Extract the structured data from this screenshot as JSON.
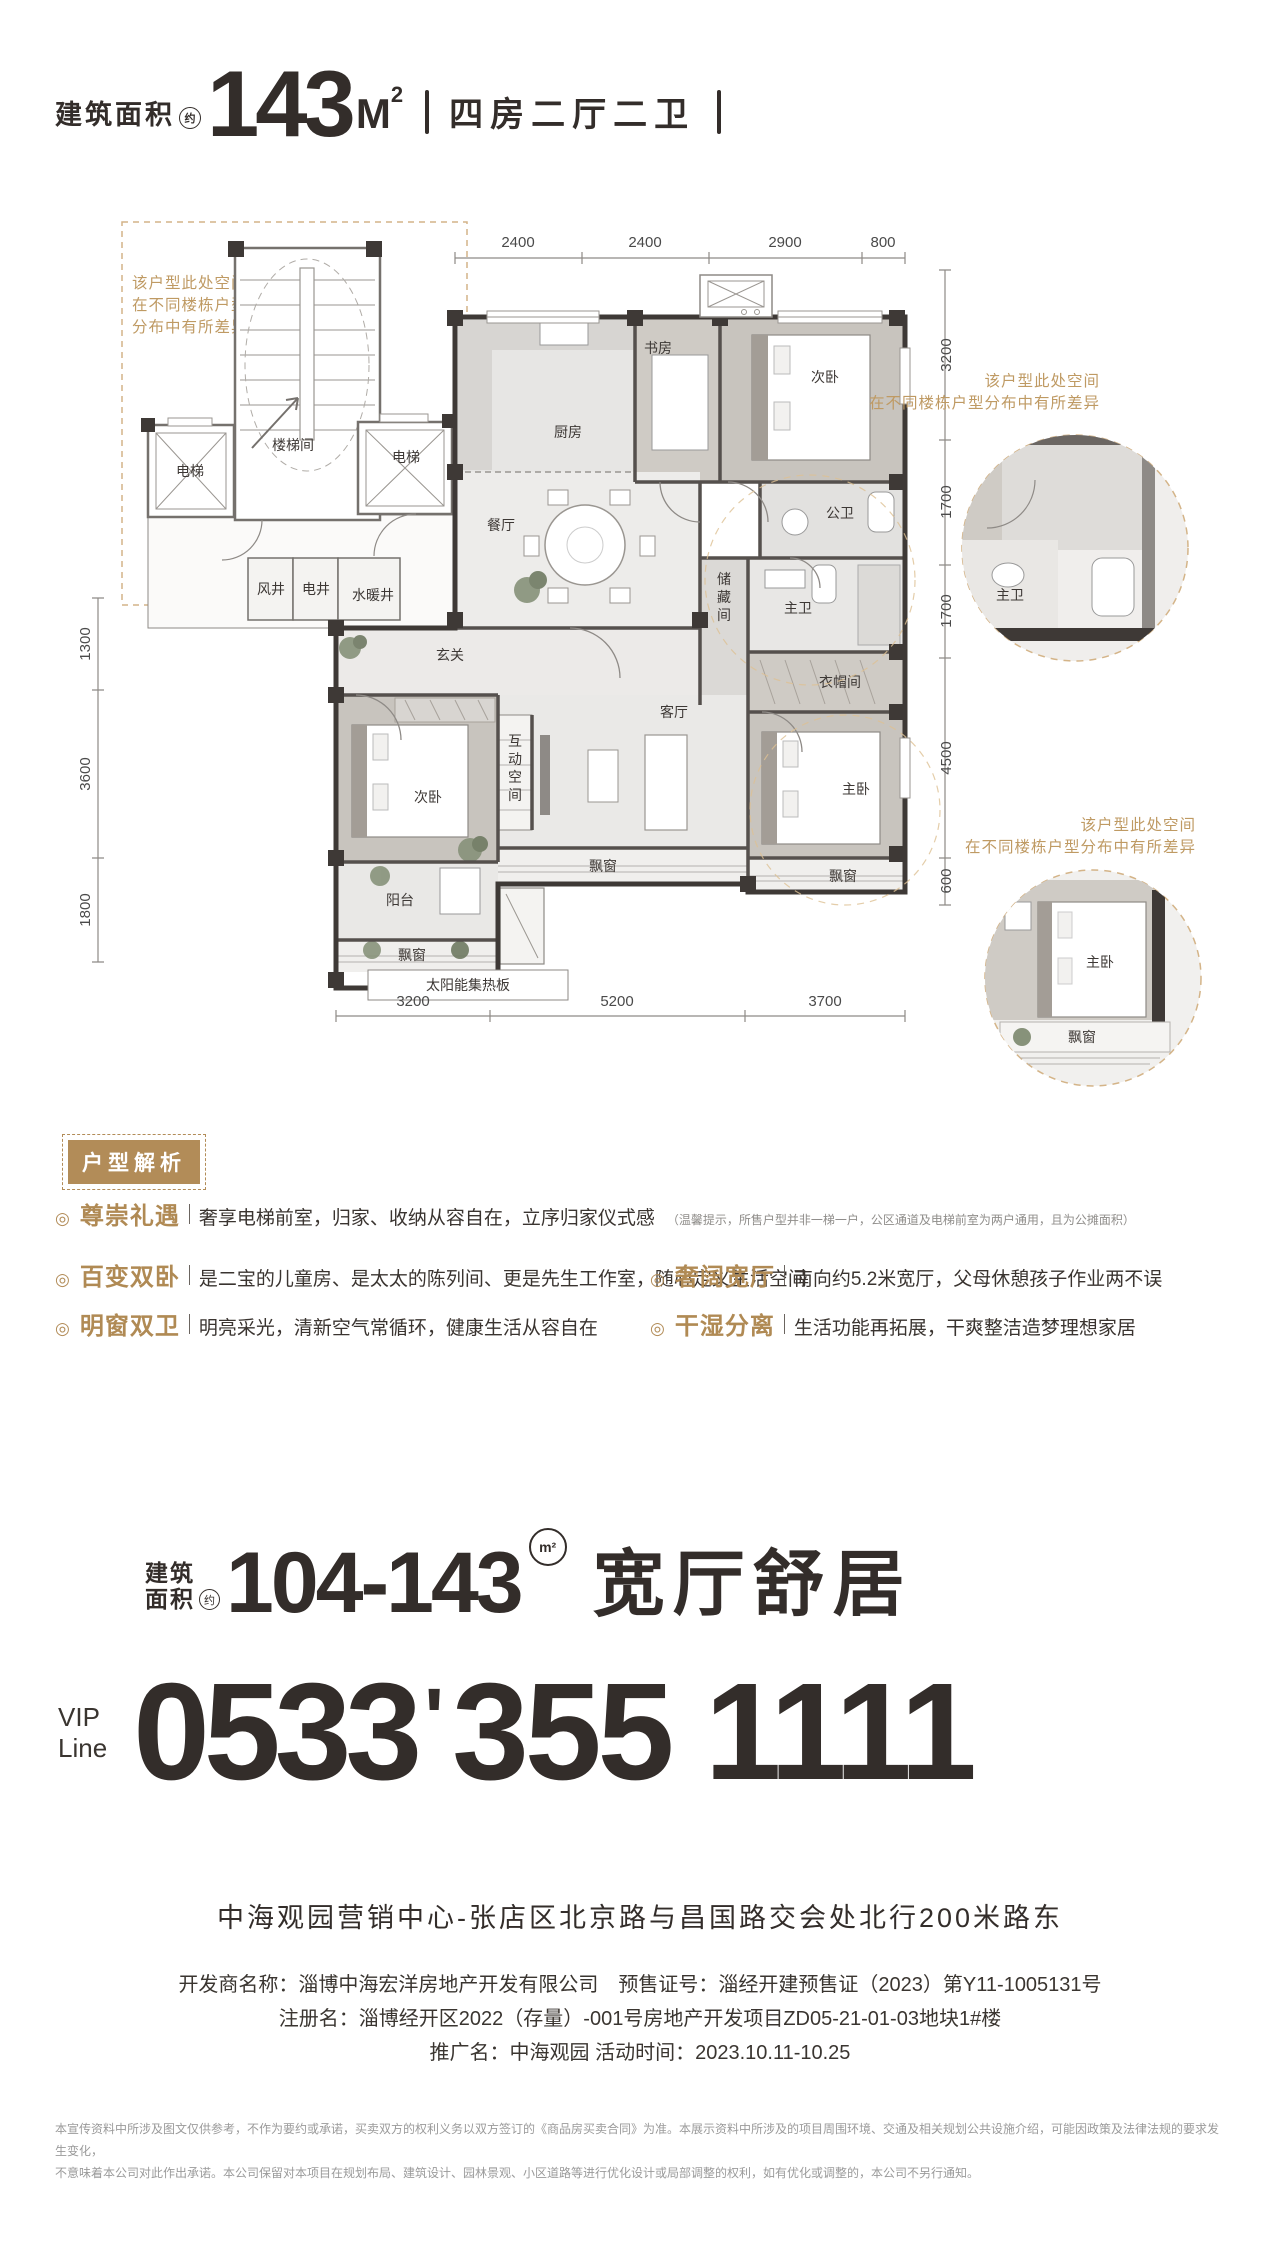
{
  "header": {
    "area_label": "建筑面积",
    "approx": "约",
    "area_value": "143",
    "area_unit": "M",
    "area_sup": "2",
    "layout": "四房二厅二卫"
  },
  "floor_plan": {
    "dims_top": [
      "2400",
      "2400",
      "2900",
      "800"
    ],
    "dims_right": [
      "3200",
      "1700",
      "1700",
      "4500",
      "600"
    ],
    "dims_left": [
      "1300",
      "3600",
      "1800"
    ],
    "dims_bottom": [
      "3200",
      "5200",
      "3700"
    ],
    "note_left": [
      "该户型此处空间",
      "在不同楼栋户型",
      "分布中有所差异"
    ],
    "note_right_top": [
      "该户型此处空间",
      "在不同楼栋户型分布中有所差异"
    ],
    "note_right_bottom": [
      "该户型此处空间",
      "在不同楼栋户型分布中有所差异"
    ],
    "rooms": {
      "stairwell": "楼梯间",
      "elevator": "电梯",
      "wind_well": "风井",
      "elec_well": "电井",
      "water_well": "水暖井",
      "kitchen": "厨房",
      "study": "书房",
      "bedroom2": "次卧",
      "dining": "餐厅",
      "guest_bath": "公卫",
      "master_bath": "主卫",
      "cloakroom": "衣帽间",
      "master": "主卧",
      "bay_window": "飘窗",
      "entry": "玄关",
      "living": "客厅",
      "balcony": "阳台",
      "solar": "太阳能集热板",
      "storage_chars": [
        "储",
        "藏",
        "间"
      ],
      "interactive_chars": [
        "互",
        "动",
        "空",
        "间"
      ]
    }
  },
  "analysis": {
    "badge": "户型解析",
    "bullet_glyph": "◎",
    "items": [
      {
        "title": "尊崇礼遇",
        "desc": "奢享电梯前室，归家、收纳从容自在，立序归家仪式感",
        "note": "（温馨提示，所售户型并非一梯一户，公区通道及电梯前室为两户通用，且为公摊面积）"
      },
      {
        "title": "百变双卧",
        "desc": "是二宝的儿童房、是太太的陈列间、更是先生工作室，随心定义生活空间"
      },
      {
        "title": "明窗双卫",
        "desc": "明亮采光，清新空气常循环，健康生活从容自在"
      },
      {
        "title": "奢阔宽厅",
        "desc": "南向约5.2米宽厅，父母休憩孩子作业两不误"
      },
      {
        "title": "干湿分离",
        "desc": "生活功能再拓展，干爽整洁造梦理想家居"
      }
    ]
  },
  "range_banner": {
    "area_label_line1": "建筑",
    "area_label_line2": "面积",
    "approx": "约",
    "range": "104-143",
    "unit": "m²",
    "slogan": "宽厅舒居"
  },
  "vip": {
    "label_line1": "VIP",
    "label_line2": "Line",
    "prefix": "0533",
    "separator": "'",
    "number": "355 1111"
  },
  "address": "中海观园营销中心-张店区北京路与昌国路交会处北行200米路东",
  "legal_lines": [
    "开发商名称：淄博中海宏洋房地产开发有限公司　预售证号：淄经开建预售证（2023）第Y11-1005131号",
    "注册名：淄博经开区2022（存量）-001号房地产开发项目ZD05-21-01-03地块1#楼",
    "推广名：中海观园 活动时间：2023.10.11-10.25"
  ],
  "disclaimer_lines": [
    "本宣传资料中所涉及图文仅供参考，不作为要约或承诺，买卖双方的权利义务以双方签订的《商品房买卖合同》为准。本展示资料中所涉及的项目周围环境、交通及相关规划公共设施介绍，可能因政策及法律法规的要求发生变化，",
    "不意味着本公司对此作出承诺。本公司保留对本项目在规划布局、建筑设计、园林景观、小区道路等进行优化设计或局部调整的权利，如有优化或调整的，本公司不另行通知。"
  ],
  "colors": {
    "gold": "#b28c58",
    "dark": "#332d2a"
  }
}
